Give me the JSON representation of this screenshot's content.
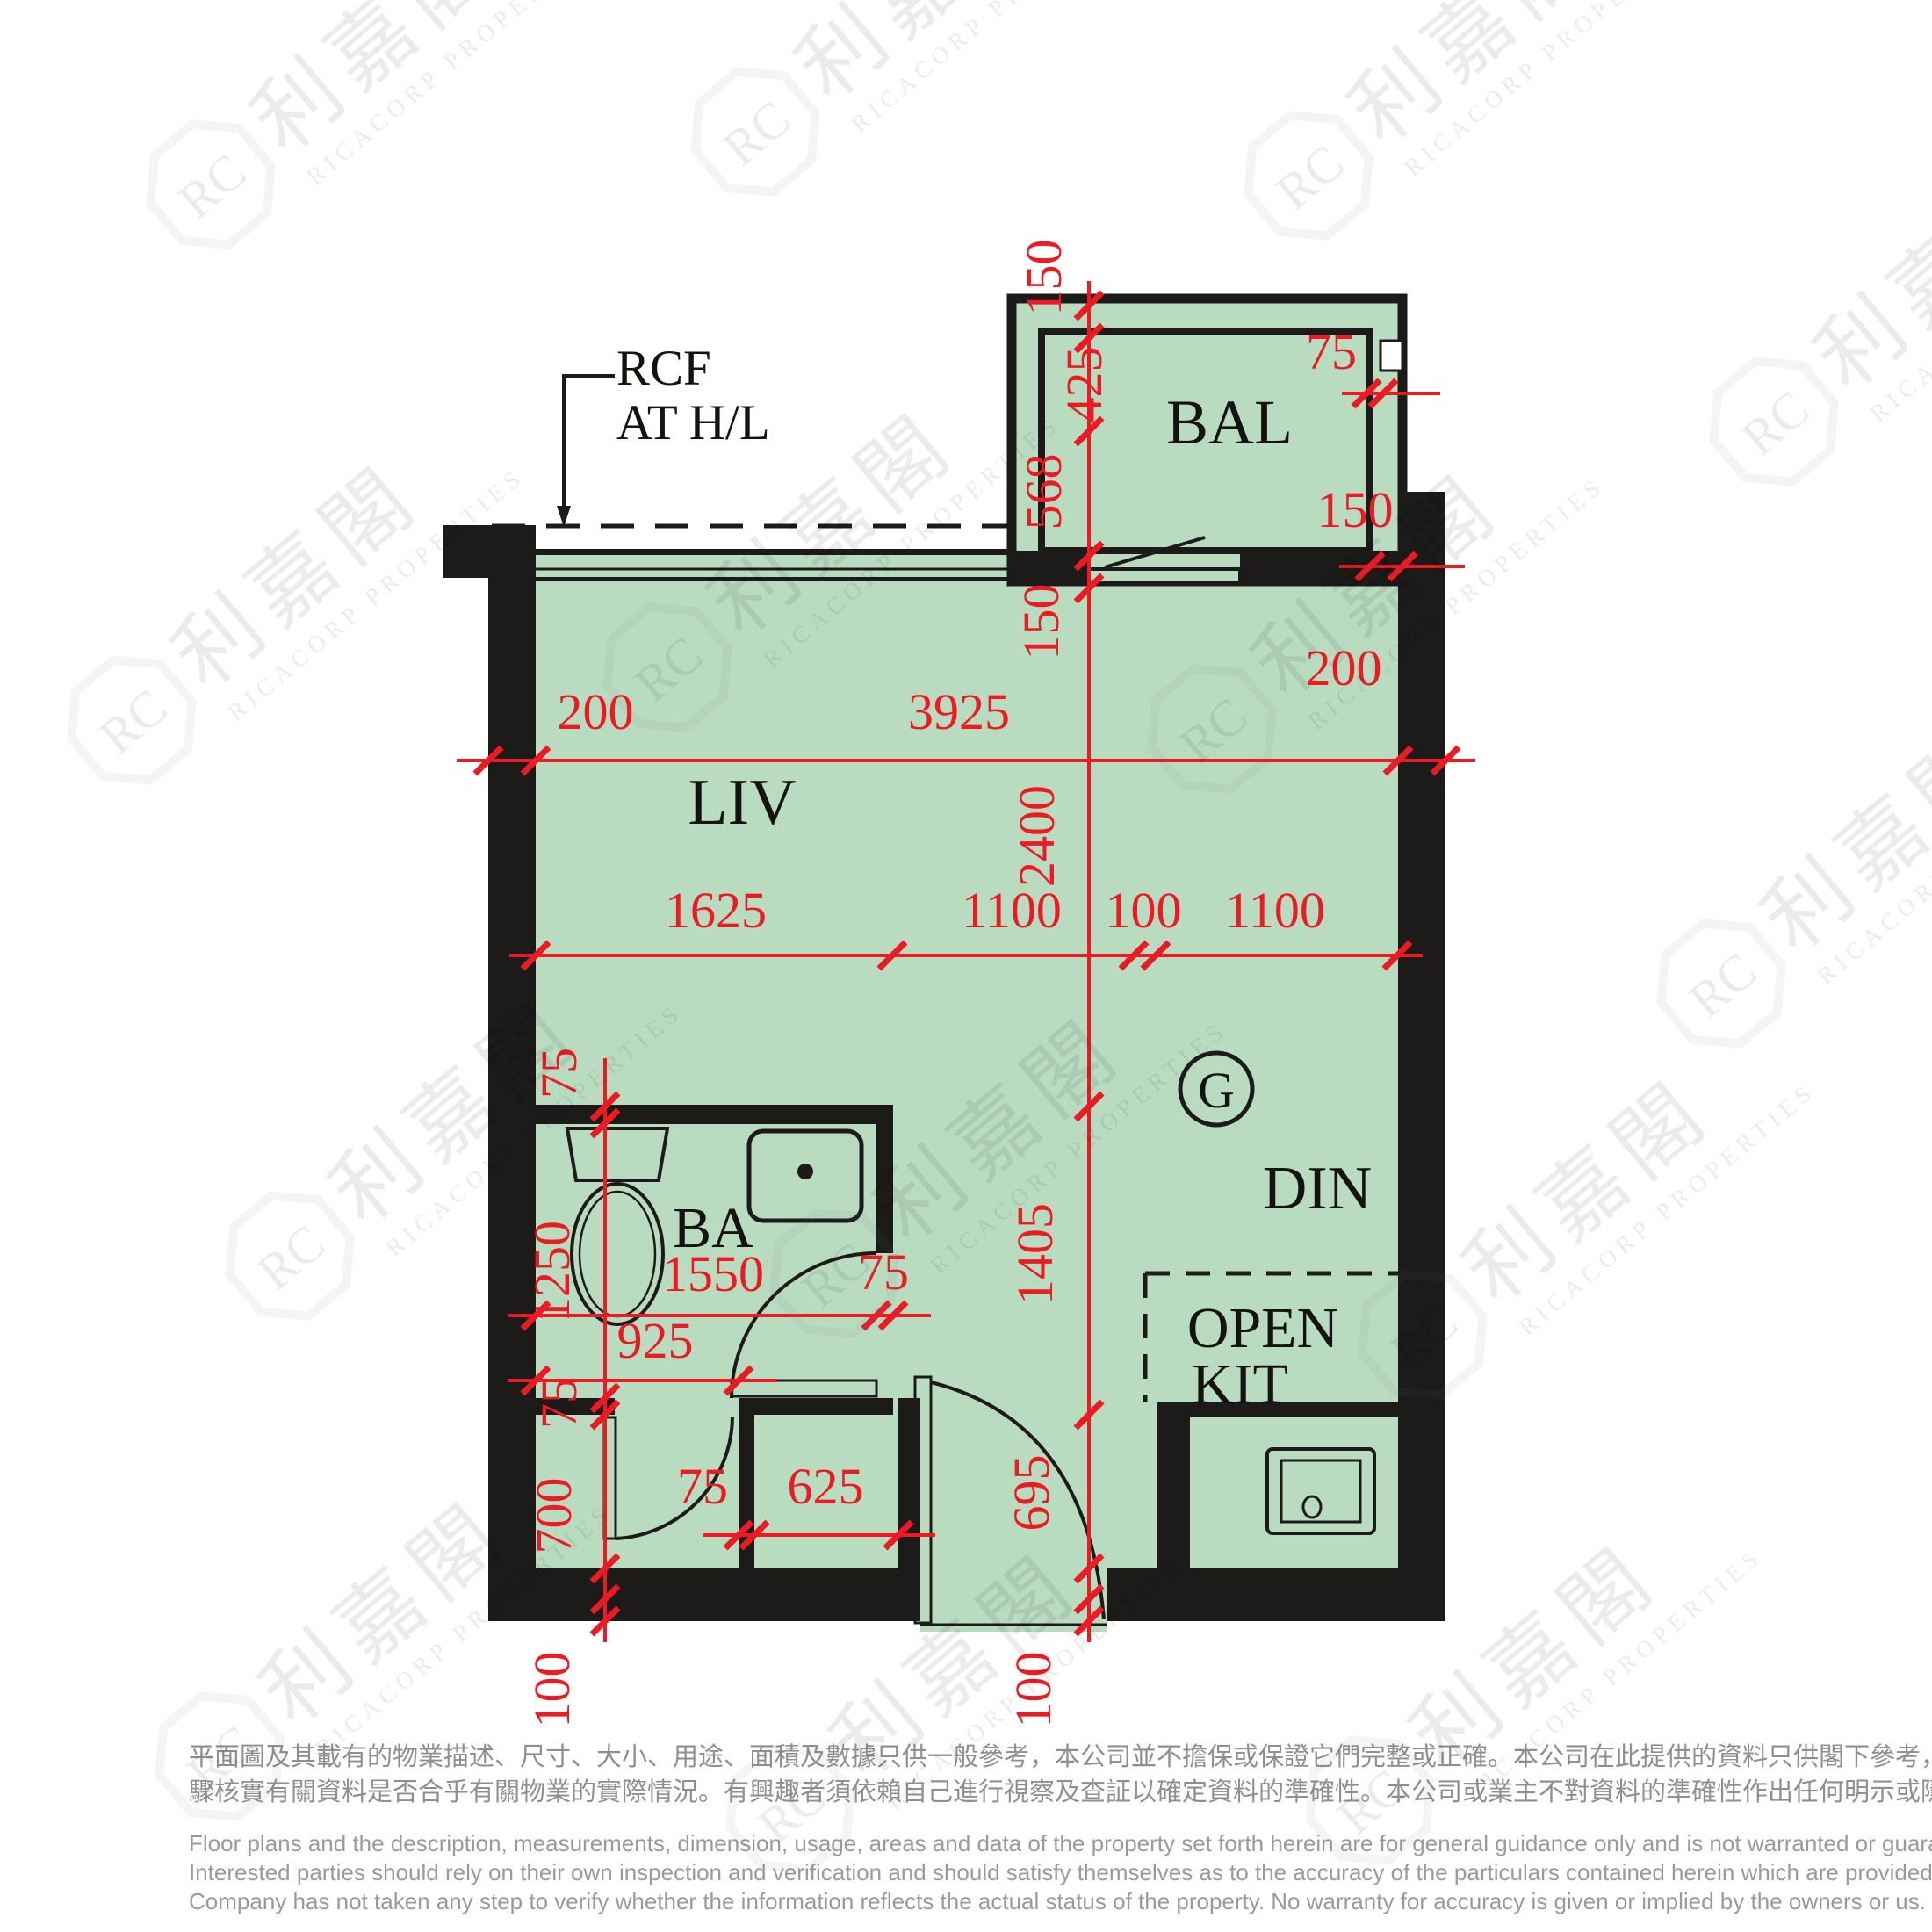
{
  "colors": {
    "floor_green": "#b9dcc1",
    "wall_black": "#1d1b19",
    "dimension_red": "#ec1b23",
    "disclaimer_gray": "#9a9a9a",
    "watermark_gray": "#6f6f6f"
  },
  "annotation": {
    "rcf_line1": "RCF",
    "rcf_line2": "AT H/L"
  },
  "rooms": {
    "living": "LIV",
    "dining": "DIN",
    "balcony": "BAL",
    "bathroom": "BA",
    "open_kitchen_line1": "OPEN",
    "open_kitchen_line2": "KIT",
    "gas_meter": "G"
  },
  "dimensions": {
    "bal_left_150": "150",
    "bal_425": "425",
    "bal_568": "568",
    "bal_right_75": "75",
    "bal_right_150": "150",
    "window_150": "150",
    "left_200": "200",
    "width_3925": "3925",
    "right_200": "200",
    "liv_2400": "2400",
    "seg_1625": "1625",
    "seg_1100a": "1100",
    "seg_100": "100",
    "seg_1100b": "1100",
    "bath_wall_75_top": "75",
    "bath_1250": "1250",
    "bath_1550": "1550",
    "bath_door_75": "75",
    "bath_925": "925",
    "din_1405": "1405",
    "bath_wall_75_bottom": "75",
    "store_700": "700",
    "part_75": "75",
    "store_625": "625",
    "entry_695": "695",
    "bottom_100_left": "100",
    "bottom_100_center": "100"
  },
  "watermark": {
    "monogram": "RC",
    "cjk": "利嘉閣",
    "latin": "RICACORP PROPERTIES"
  },
  "disclaimer": {
    "zh_line1": "平面圖及其載有的物業描述、尺寸、大小、用途、面積及數據只供一般參考，本公司並不擔保或保證它們完整或正確。本公司在此提供的資料只供閣下參考，本公司並無採取任何步",
    "zh_line2": "驟核實有關資料是否合乎有關物業的實際情況。有興趣者須依賴自己進行視察及查証以確定資料的準確性。本公司或業主不對資料的準確性作出任何明示或隱含的保證。",
    "en_line1": "Floor plans and the description, measurements, dimension, usage, areas and data of the property set forth herein are for general guidance only and is not warranted or guaranteed to be complete or correct.",
    "en_line2": "Interested parties should rely on their own inspection and verification and should satisfy themselves as to the accuracy of the particulars contained herein which are provided by us for information only.  Our",
    "en_line3": "Company has not taken any step to verify whether the information reflects the actual status of the property.  No warranty for accuracy is given or implied by the owners or us."
  }
}
